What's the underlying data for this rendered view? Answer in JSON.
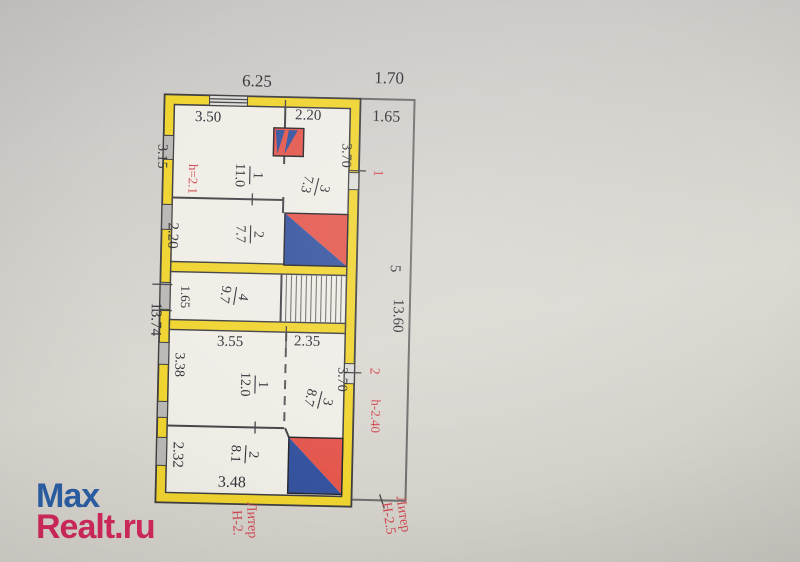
{
  "colors": {
    "wall": "#f0d430",
    "wallEdge": "#3f3f42",
    "floor": "#efede6",
    "window": "#b9b8b4",
    "windowLight": "#dddcd8",
    "stoveRed": "#e4574d",
    "stoveBlue": "#35539e",
    "red": "#cf4a52",
    "ink": "#33333a",
    "annex": "#6f6e6c",
    "wmBlue": "#2b5fa5",
    "wmPink": "#d1295b"
  },
  "watermark": {
    "line1": "Max",
    "line2": "Realt.ru"
  },
  "plan": {
    "overall": {
      "top_width": "6.25",
      "annex_top_width": "1.70",
      "annex_top_depth": "1.65",
      "left_length": "13.74",
      "right_length": "13.60",
      "annex_number": "5"
    },
    "unit1": {
      "number": "1",
      "height_note": "h=2.1",
      "room1": {
        "num": "1",
        "area": "11.0",
        "width": "3.50",
        "depth": "3.15"
      },
      "room2": {
        "num": "2",
        "area": "7.7",
        "depth": "2.20"
      },
      "room3": {
        "num": "3",
        "area": "7.3",
        "width": "2.20",
        "depth": "3.70"
      }
    },
    "corridor": {
      "num": "4",
      "area": "9.7",
      "depth": "1.65"
    },
    "unit2": {
      "number": "2",
      "height_note": "h-2.40",
      "room1": {
        "num": "1",
        "area": "12.0",
        "width": "3.55",
        "depth": "3.38"
      },
      "room2": {
        "num": "2",
        "area": "8.1",
        "width": "3.48",
        "depth": "2.32"
      },
      "room3": {
        "num": "3",
        "area": "8.7",
        "width": "2.35",
        "depth": "3.70"
      }
    },
    "captions": {
      "bottom_center_line1": "Литер",
      "bottom_center_line2": "Н-2.",
      "bottom_right_line1": "Литер",
      "bottom_right_line2": "Н-2.5"
    }
  }
}
